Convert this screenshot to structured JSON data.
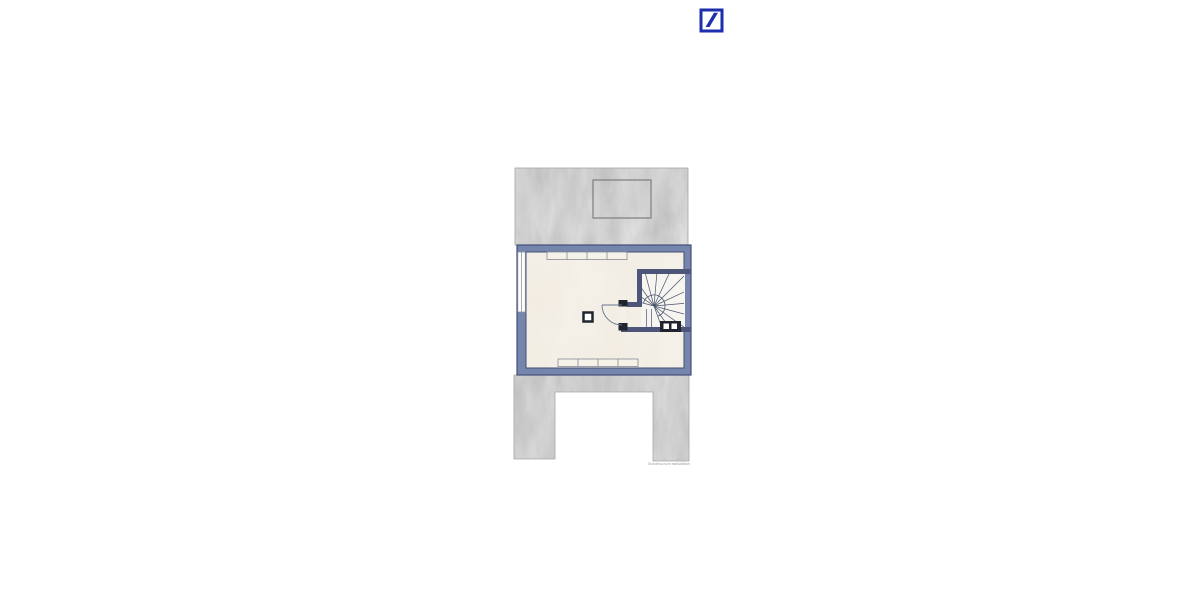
{
  "page": {
    "background": "#ffffff"
  },
  "header": {
    "logo_icon": "deutsche-bank-slash-logo",
    "logo_color": "#1d2fae"
  },
  "floor_plan": {
    "description": "attic-level floor plan with roof surfaces, one room, door and winder staircase",
    "watermark": "Grundriss nicht maßstäblich",
    "colors": {
      "wall_fill": "#7585ac",
      "wall_edge": "#454f77",
      "floor": "#f1ebe0",
      "roof_gray": "#bcbcbc",
      "stair_wall": "#4d5679",
      "detail_dark": "#20242f",
      "line_gray": "#8e94a4",
      "tread_line": "#49536f",
      "watermark_gray": "#969696"
    },
    "features": [
      "upper-roof-area",
      "skylight-opening",
      "attic-room",
      "left-wall-window",
      "top-wardrobe-strip",
      "bottom-wardrobe-strip",
      "chimney-column",
      "stair-door-with-swing",
      "winder-staircase",
      "chimney-block",
      "lower-roof-area-u-shape"
    ]
  }
}
